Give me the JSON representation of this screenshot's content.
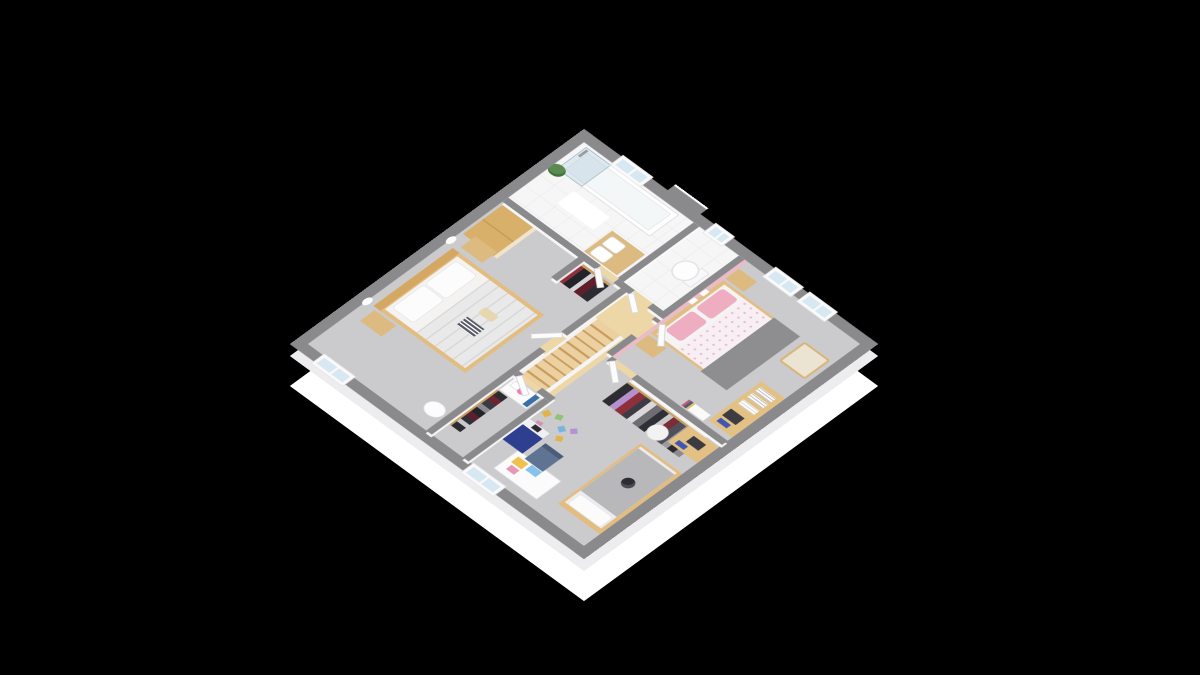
{
  "scene": {
    "title": "3D isometric floor plan of an upper storey",
    "style": "architectural dollhouse render on black background",
    "background_color": "#000000",
    "palette": {
      "wall_top": "#8a8a8d",
      "exterior_face": "#ffffff",
      "carpet": "#cbcbcd",
      "bathroom_tile": "#f6f6f7",
      "hallway_wood": "#eed7a6",
      "furniture_wood": "#ddba80",
      "accent_pink_wall": "#efb9c6",
      "pink_bedding": "#eeadc1",
      "gray_bedding": "#8e8e91",
      "window_glass": "#d8e8f2",
      "toy_box_blue": "#2e3f90",
      "desk_chair_blue": "#5f7392",
      "lamp_pink": "#ec7fb2"
    },
    "rooms": [
      {
        "name": "bathroom",
        "floor": "white tile",
        "furniture": [
          "bathtub",
          "shower screen",
          "shower head",
          "double washbasin vanity",
          "green plant",
          "bath mat",
          "window"
        ]
      },
      {
        "name": "wc",
        "floor": "white tile",
        "furniture": [
          "toilet",
          "small window"
        ]
      },
      {
        "name": "master bedroom",
        "floor": "gray carpet",
        "furniture": [
          "double bed with white bedding",
          "stack of books on bed",
          "two wooden nightstands",
          "two wall sconces",
          "wooden wardrobe",
          "closet rack with clothes",
          "round stool",
          "window"
        ]
      },
      {
        "name": "pink bedroom",
        "floor": "gray carpet",
        "furniture": [
          "double bed with pink pillows and gray throw",
          "two wooden nightstands",
          "pink accent wall with shelves",
          "wooden armchair",
          "desk with book stacks",
          "shelf with books",
          "two windows"
        ]
      },
      {
        "name": "kids bedroom",
        "floor": "gray carpet",
        "furniture": [
          "single bed with plush toy",
          "open wardrobe rack with clothes",
          "white floor lamp",
          "desk with speaker and books",
          "play desk with drawings",
          "blue chair",
          "toy blocks",
          "navy toy box",
          "window"
        ]
      },
      {
        "name": "dressing room",
        "floor": "gray carpet",
        "furniture": [
          "dark clothes rack",
          "white dresser with pink lamp and picture"
        ]
      },
      {
        "name": "hallway",
        "floor": "light wood",
        "furniture": [
          "staircase",
          "white railing",
          "doors"
        ]
      }
    ]
  }
}
